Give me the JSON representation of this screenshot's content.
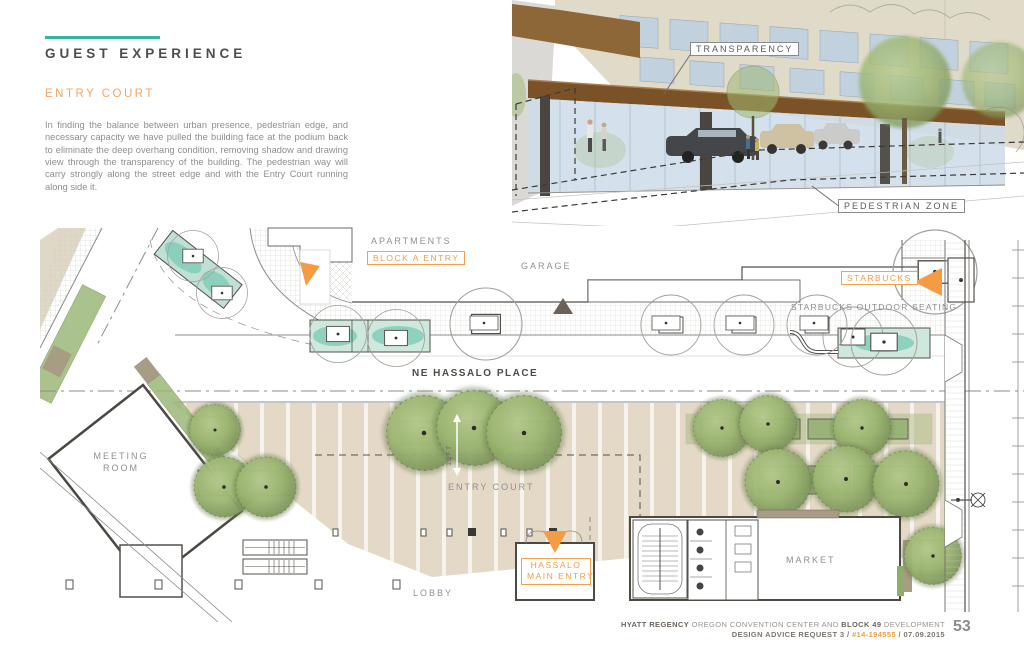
{
  "header": {
    "section_title": "GUEST EXPERIENCE",
    "subsection_title": "ENTRY COURT",
    "body_text": "In finding the balance between urban presence, pedestrian edge, and necessary capacity we have pulled the building face at the podium back to eliminate the deep overhang condition, removing shadow and drawing view through the transparency of the building.  The pedestrian way will carry strongly along the street edge and with the Entry Court running along side it."
  },
  "rendering": {
    "transparency_label": "TRANSPARENCY",
    "pedestrian_zone_label": "PEDESTRIAN ZONE"
  },
  "plan": {
    "apartments_label": "APARTMENTS",
    "block_a_entry_label": "BLOCK A ENTRY",
    "garage_label": "GARAGE",
    "starbucks_label": "STARBUCKS",
    "starbucks_seating_label": "STARBUCKS OUTDOOR SEATING",
    "street_label": "NE HASSALO PLACE",
    "meeting_room_label_line1": "MEETING",
    "meeting_room_label_line2": "ROOM",
    "entry_court_label": "ENTRY COURT",
    "tree_spacing_dimension": "12FT",
    "hassalo_entry_line1": "HASSALO",
    "hassalo_entry_line2": "MAIN ENTRY",
    "lobby_label": "LOBBY",
    "market_label": "MARKET"
  },
  "footer": {
    "project_name_bold": "HYATT REGENCY",
    "project_name_rest": " OREGON CONVENTION CENTER AND ",
    "project_block_bold": "BLOCK 49",
    "project_suffix": " DEVELOPMENT",
    "submission": "DESIGN ADVICE REQUEST 3 / ",
    "case_number": "#14-194555",
    "date_suffix": " / 07.09.2015",
    "page_number": "53"
  },
  "colors": {
    "accent_teal": "#35b5a2",
    "accent_orange": "#f49b43",
    "heading_gray": "#4d4d4f",
    "body_gray": "#8e8e90",
    "paving_tan": "#e3d9c6",
    "planter_teal": "#84cbb8",
    "tree_green": "#9db96f"
  }
}
